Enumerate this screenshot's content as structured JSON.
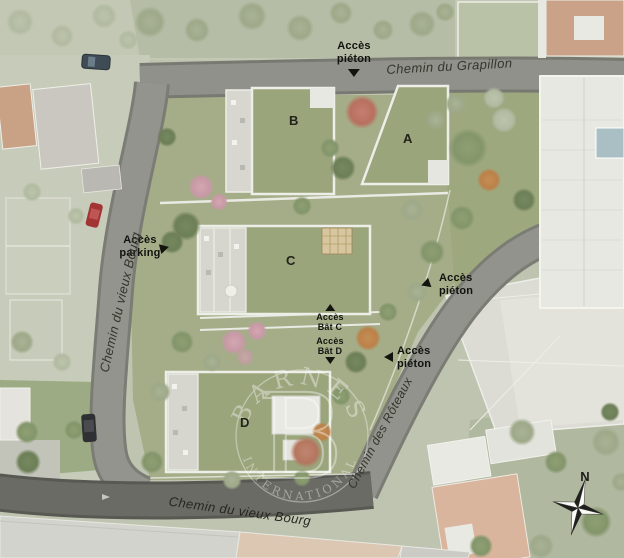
{
  "plan": {
    "streets": {
      "grapillon": "Chemin du Grapillon",
      "vieux_bourg_left": "Chemin du vieux Bourg",
      "vieux_bourg_bottom": "Chemin du vieux Bourg",
      "roteaux": "Chemin des Rôteaux"
    },
    "buildings": {
      "a": "A",
      "b": "B",
      "c": "C",
      "d": "D"
    },
    "access": {
      "pieton_top": {
        "line1": "Accès",
        "line2": "piéton"
      },
      "parking": {
        "line1": "Accès",
        "line2": "parking"
      },
      "bat_c": {
        "line1": "Accès",
        "line2": "Bât C"
      },
      "bat_d": {
        "line1": "Accès",
        "line2": "Bât D"
      },
      "pieton_mid": {
        "line1": "Accès",
        "line2": "piéton"
      },
      "pieton_low": {
        "line1": "Accès",
        "line2": "piéton"
      }
    },
    "compass": {
      "north": "N"
    },
    "watermark": {
      "arc_top": "BARNES",
      "monogram": "B",
      "arc_bottom": "INTERNATIONAL"
    },
    "colors": {
      "lawn": "#a5ad88",
      "road": "#90918b",
      "asphalt": "#6a6b64",
      "green_roof": "#9aa57c",
      "tan_roof": "#c9a287",
      "white_roof": "#e8e8e2",
      "pool": "#aabfc4",
      "label_text": "#14140f"
    }
  }
}
